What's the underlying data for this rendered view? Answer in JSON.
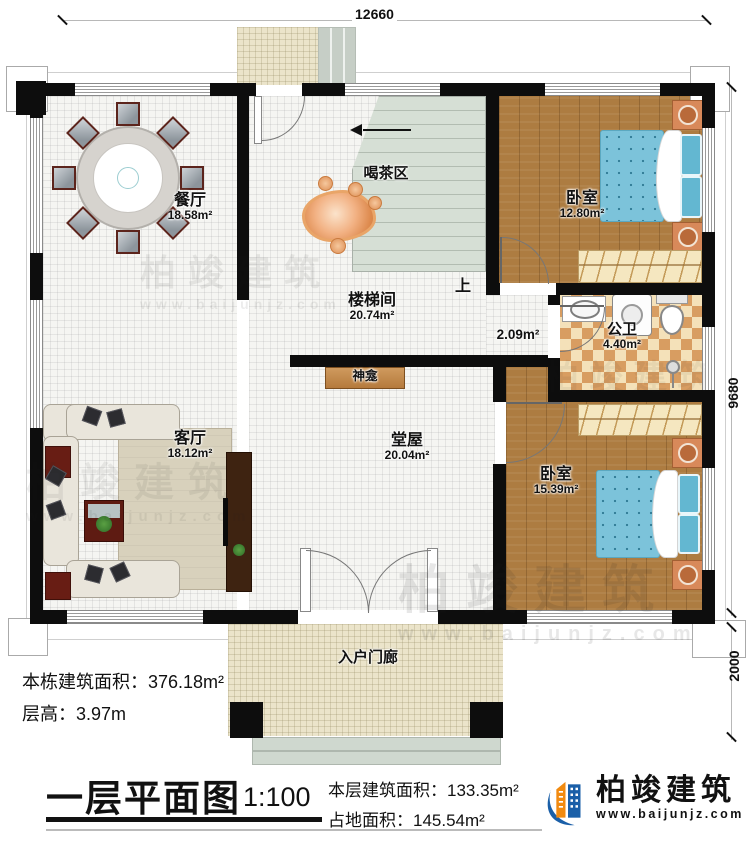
{
  "dimensions": {
    "top": "12660",
    "right_main": "9680",
    "right_porch": "2000"
  },
  "rooms": {
    "dining": {
      "name": "餐厅",
      "area": "18.58m²"
    },
    "tea": {
      "name": "喝茶区"
    },
    "stairwell": {
      "name": "楼梯间",
      "area": "20.74m²",
      "up": "上"
    },
    "bedroom_top": {
      "name": "卧室",
      "area": "12.80m²"
    },
    "bathroom": {
      "name": "公卫",
      "area": "4.40m²"
    },
    "corridor": {
      "area": "2.09m²"
    },
    "living": {
      "name": "客厅",
      "area": "18.12m²"
    },
    "hall": {
      "name": "堂屋",
      "area": "20.04m²"
    },
    "bedroom_bottom": {
      "name": "卧室",
      "area": "15.39m²"
    },
    "porch": {
      "name": "入户门廊"
    },
    "shrine": {
      "name": "神龛"
    }
  },
  "footer": {
    "building_area_label": "本栋建筑面积：",
    "building_area_value": "376.18m²",
    "floor_height_label": "层高：",
    "floor_height_value": "3.97m",
    "plan_title": "一层平面图",
    "scale": "1:100",
    "floor_area_label": "本层建筑面积：",
    "floor_area_value": "133.35m²",
    "land_area_label": "占地面积：",
    "land_area_value": "145.54m²"
  },
  "brand": {
    "name": "柏竣建筑",
    "url": "www.baijunjz.com"
  },
  "watermark": {
    "name": "柏竣建筑",
    "url": "www.baijunjz.com"
  },
  "colors": {
    "brand_blue": "#1a5fa8",
    "brand_orange": "#f18a10",
    "wall": "#0d0d0d"
  }
}
